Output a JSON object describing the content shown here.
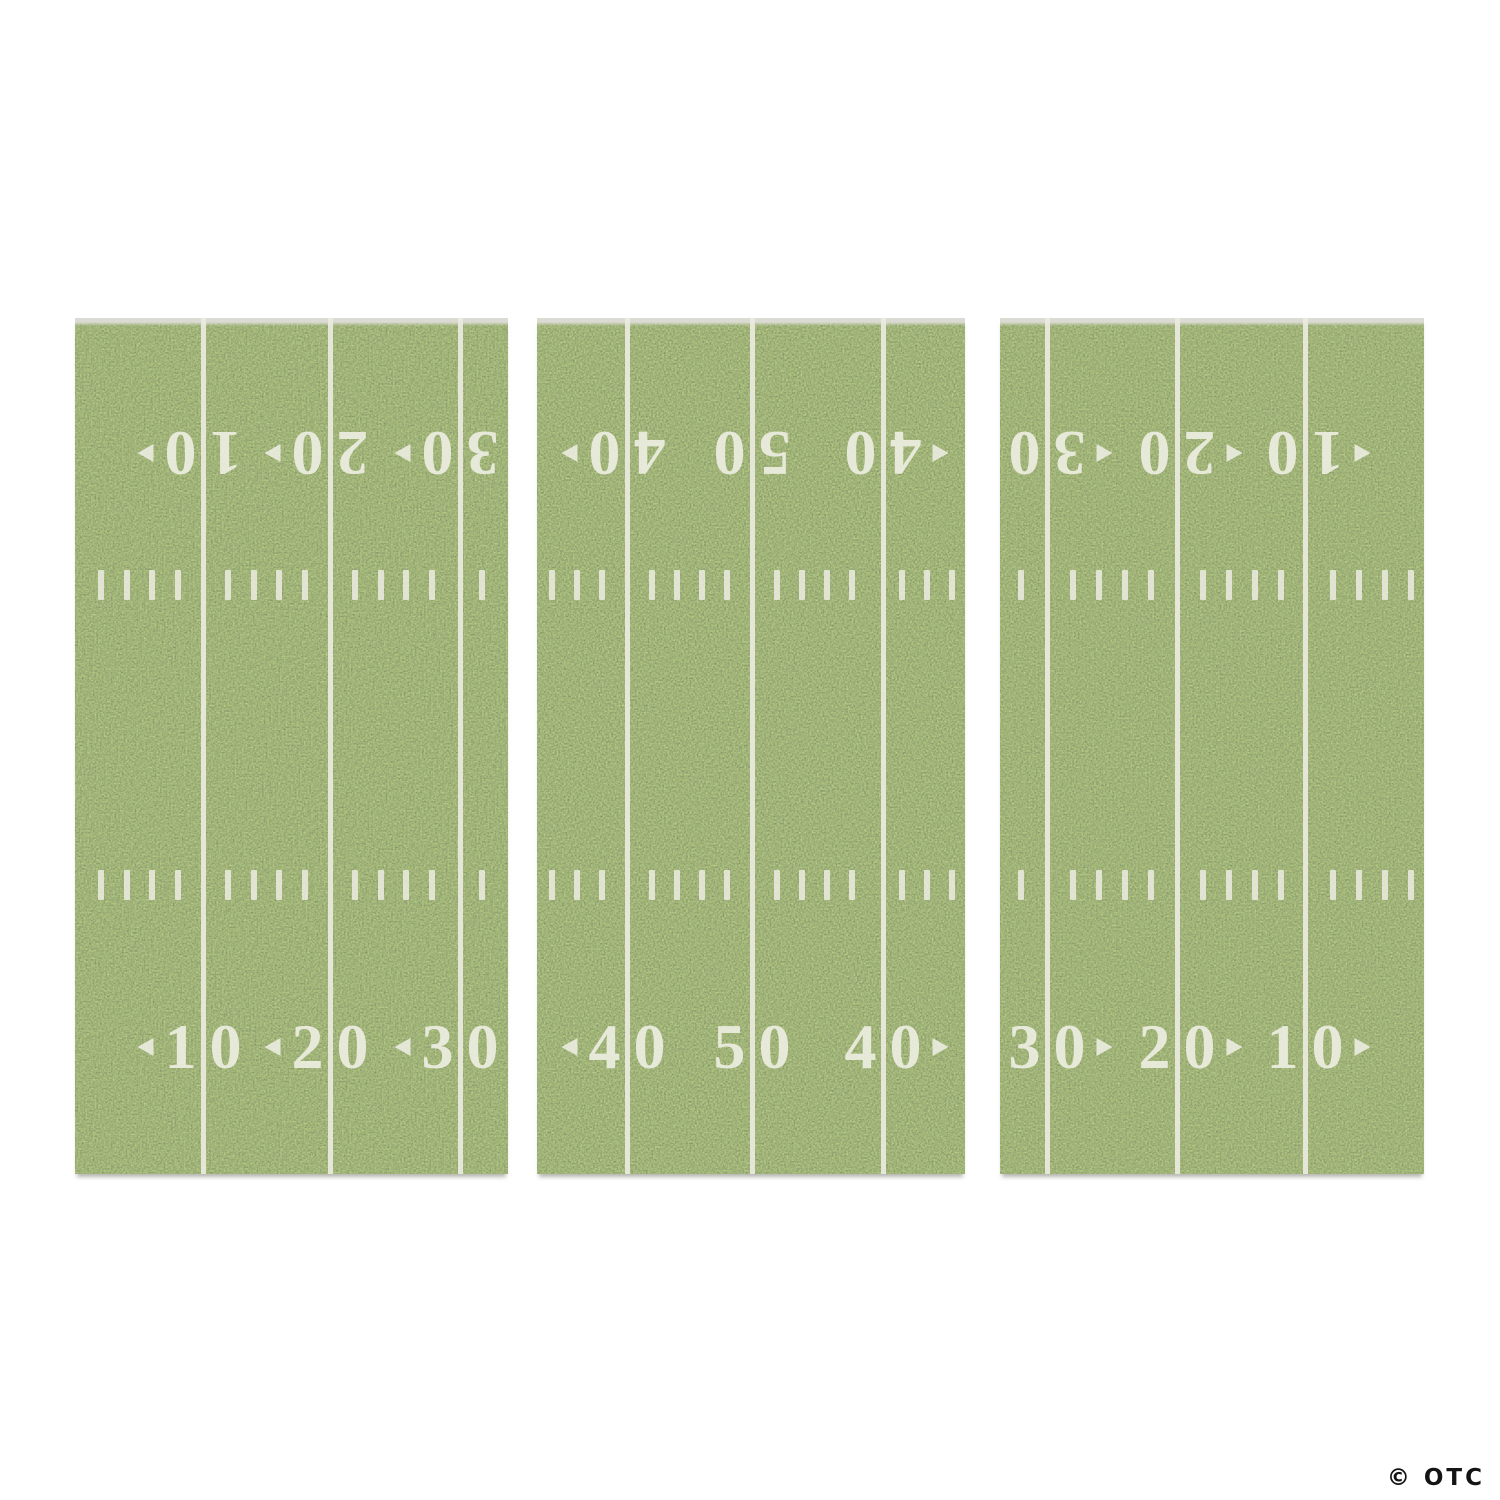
{
  "product": {
    "description": "Football field backdrop wall decoration, 3 grass panels with yard lines"
  },
  "watermark": {
    "text": "© OTC"
  },
  "colors": {
    "background": "#ffffff",
    "grass_base": "#5e6f3e",
    "marking_white": "#ecece2",
    "watermark_dark": "#141414"
  },
  "field_spec": {
    "panel_top": 318,
    "panel_height": 856,
    "number_row_top_y": 135,
    "number_row_bottom_y": 729,
    "hash_row1_y": 267,
    "hash_row2_y": 567,
    "hash_height": 30,
    "line_width": 5
  },
  "panels": [
    {
      "id": "left",
      "x": 75,
      "width": 433,
      "lines": [
        128,
        255,
        385
      ],
      "numbers": [
        {
          "value": "10",
          "arrow": "left"
        },
        {
          "value": "20",
          "arrow": "left"
        },
        {
          "value": "30",
          "arrow": "left"
        }
      ]
    },
    {
      "id": "center",
      "x": 537,
      "width": 428,
      "lines": [
        90,
        215,
        346
      ],
      "numbers": [
        {
          "value": "40",
          "arrow": "left"
        },
        {
          "value": "50",
          "arrow": "none"
        },
        {
          "value": "40",
          "arrow": "right"
        }
      ]
    },
    {
      "id": "right",
      "x": 1000,
      "width": 424,
      "lines": [
        47,
        177,
        305
      ],
      "numbers": [
        {
          "value": "30",
          "arrow": "right"
        },
        {
          "value": "20",
          "arrow": "right"
        },
        {
          "value": "10",
          "arrow": "right"
        }
      ]
    }
  ]
}
